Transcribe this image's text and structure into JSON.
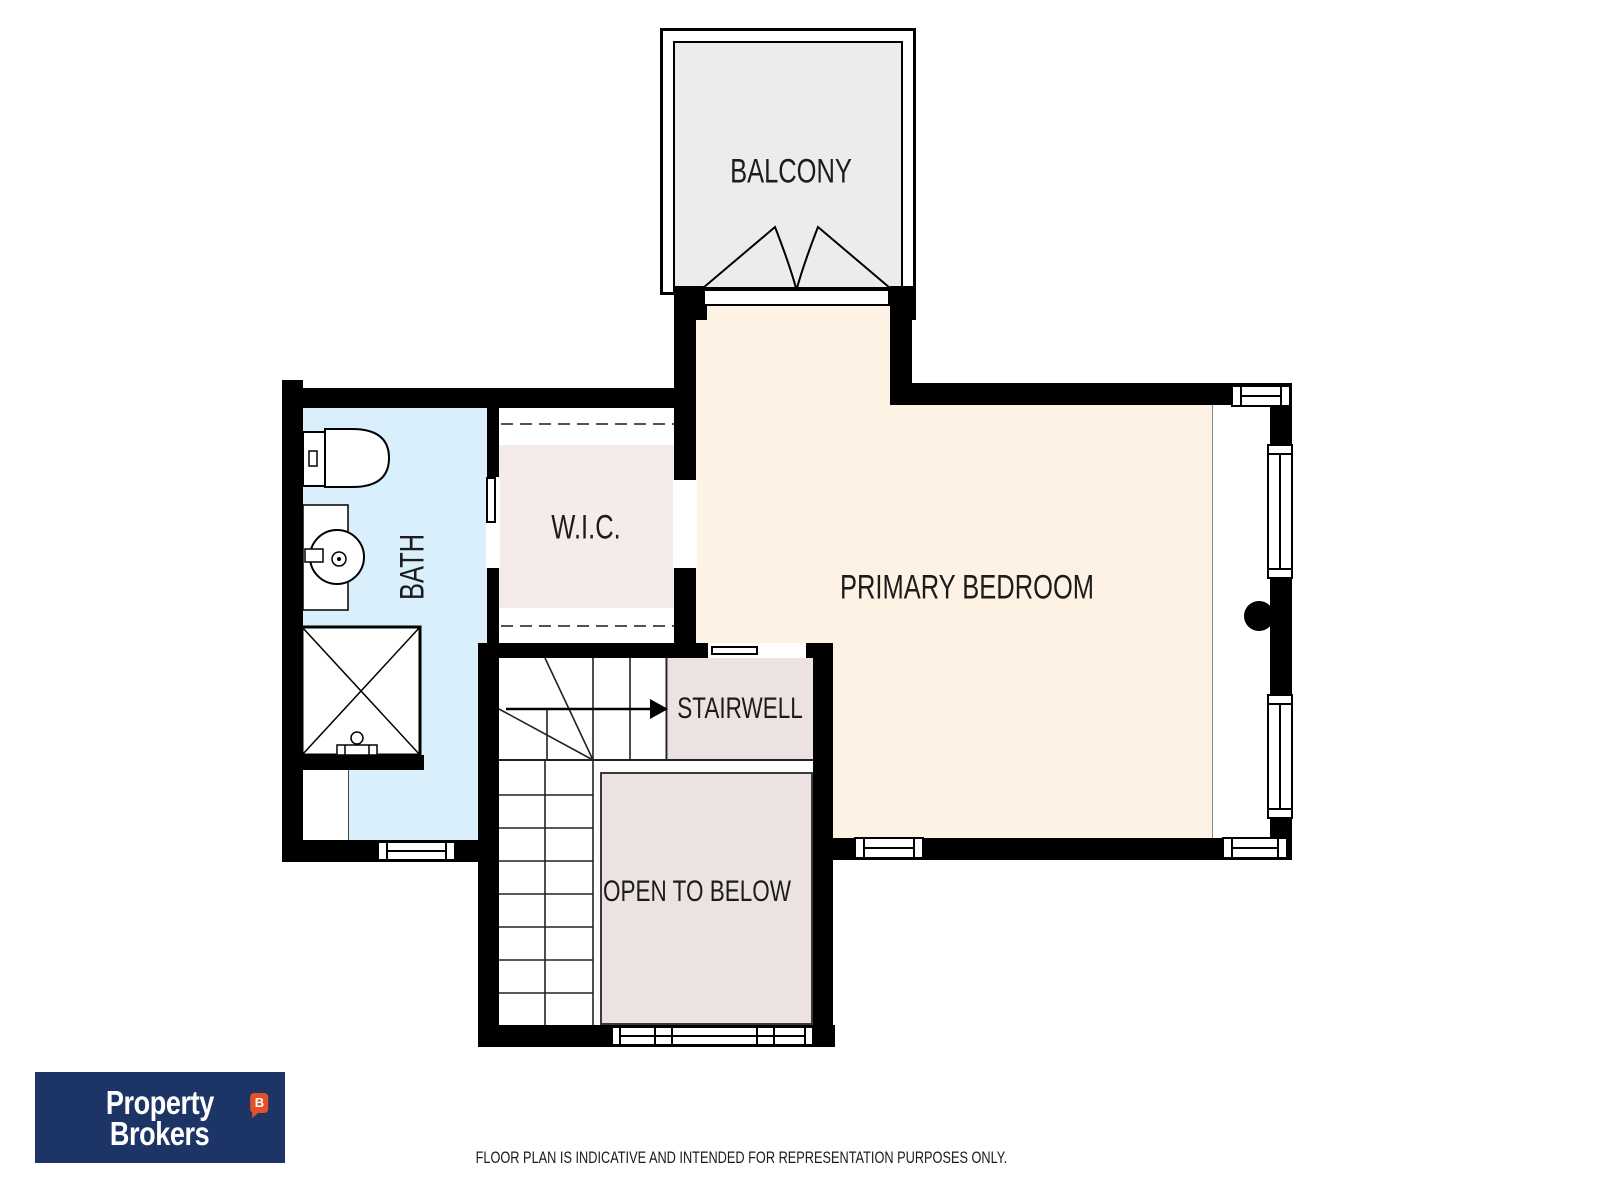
{
  "floor_plan": {
    "rooms": {
      "balcony": {
        "label": "BALCONY"
      },
      "primary_bedroom": {
        "label": "PRIMARY BEDROOM"
      },
      "wic": {
        "label": "W.I.C."
      },
      "bath": {
        "label": "BATH"
      },
      "stairwell": {
        "label": "STAIRWELL"
      },
      "open_to_below": {
        "label": "OPEN TO BELOW"
      }
    },
    "fixtures": [
      "toilet",
      "vanity-sink",
      "shower",
      "stairs",
      "balcony-double-doors",
      "windows",
      "pocket-doors"
    ],
    "colors": {
      "wall": "#000000",
      "bedroom_fill": "#fdf2e3",
      "bath_fill": "#d9effb",
      "wic_fill": "#f5ebe9",
      "stair_fill": "#ece2e2",
      "balcony_fill": "#ececec",
      "open_below_border": "#3a3a3a",
      "label_text": "#1c1c1c"
    }
  },
  "branding": {
    "logo_line1": "Property",
    "logo_line2": "Brokers",
    "logo_badge": "B",
    "logo_navy": "#1c3566",
    "logo_red": "#e3512b"
  },
  "footer": {
    "disclaimer": "FLOOR PLAN IS INDICATIVE AND INTENDED FOR REPRESENTATION PURPOSES ONLY."
  }
}
